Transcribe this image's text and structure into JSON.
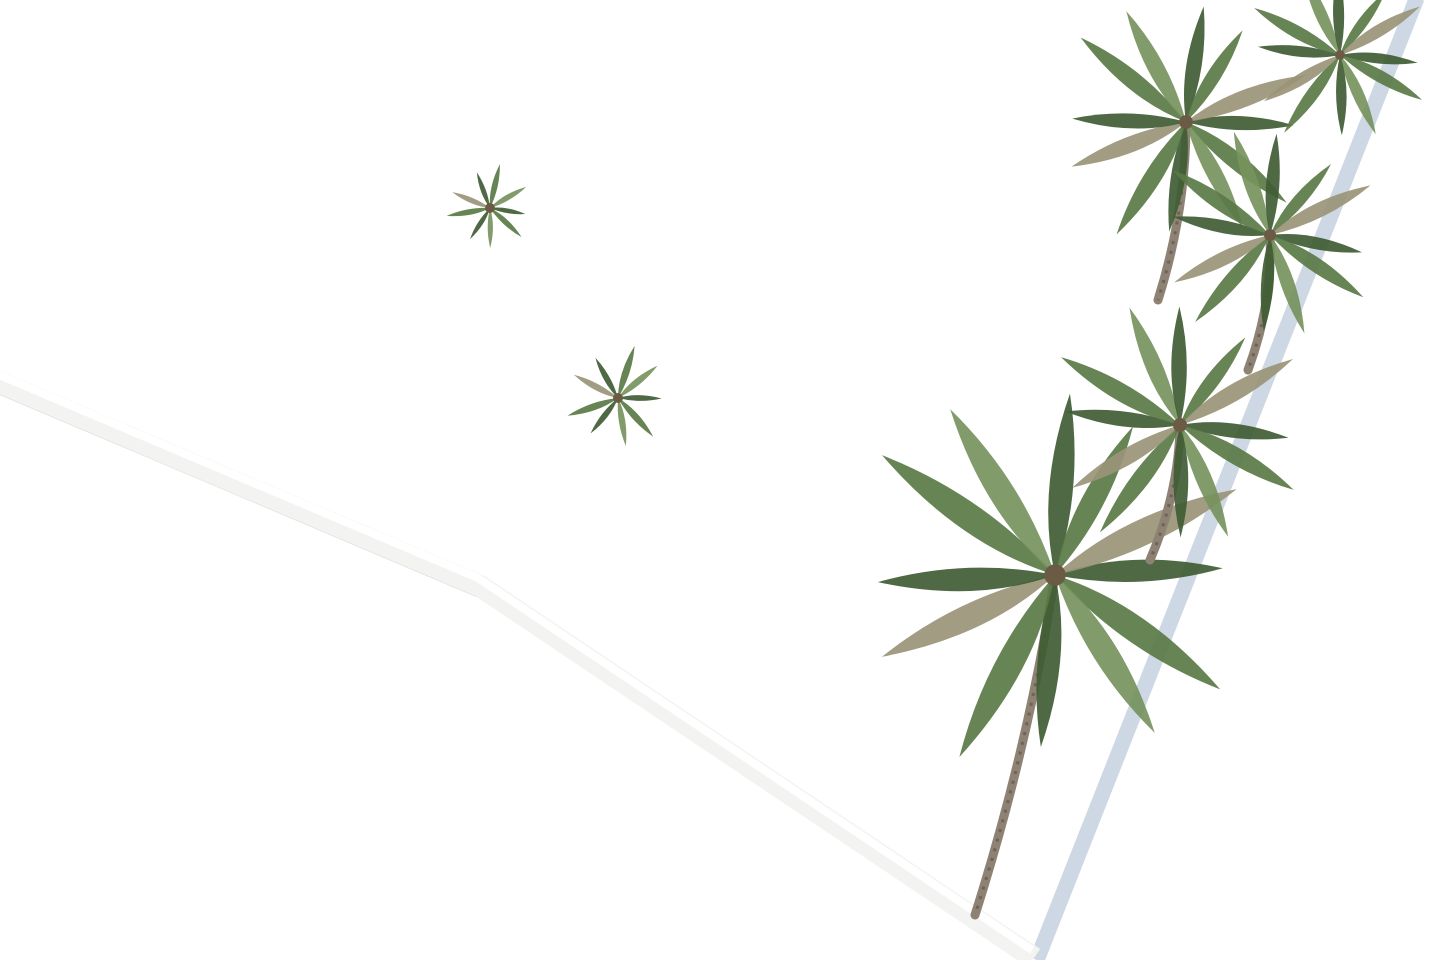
{
  "scene": {
    "type": "aerial-3d-architectural-render",
    "palette": {
      "bg": "#ffffff",
      "paving": "#dfdfda",
      "tile_line": "#c9c9c2",
      "villa_white": "#fcfdfd",
      "villa_face": "#f2f3f4",
      "villa_shade": "#e4e7e9",
      "roof_floor": "#e7dcc9",
      "roof_floor_line": "#d9cdb8",
      "window_dark": "#22262b",
      "wood": "#b38b5b",
      "pool_rim": "#f6f6f3",
      "water_light": "#7de4e9",
      "water_mid": "#3cc4d4",
      "water_deep": "#1da0b8",
      "water_teal_light": "#5fd6c6",
      "water_teal_deep": "#23a496",
      "lawn": "#2f5526",
      "lawn_dark": "#24421c",
      "bush_dark": "#27461e",
      "bush_mid": "#35602a",
      "bush_light": "#4d8040",
      "palm_dark": "#3f5c33",
      "palm_mid": "#5a7a46",
      "palm_light": "#76925d",
      "palm_dry": "#9a9478",
      "trunk": "#8e8274",
      "street_dark": "#141619",
      "gate_darker": "#0d0f10",
      "gravel": "#d8d4cc",
      "wall_white": "#f3f4f2",
      "wall_blue": "#cdd8e4",
      "wall_shadow": "#aebecd",
      "wall_under": "#d8dad7",
      "car_silver": "#cac6bd",
      "car_silver_edge": "#aaa69c",
      "car_glass": "#1a1c1e",
      "car_dark": "#262e3e",
      "car_dark_glass": "#0e1116",
      "shadow": "#343a40"
    },
    "site": {
      "polygon": [
        [
          0,
          0
        ],
        [
          1410,
          0
        ],
        [
          1032,
          956
        ],
        [
          482,
          585
        ],
        [
          0,
          378
        ]
      ],
      "right_wall": [
        [
          1412,
          -4
        ],
        [
          1032,
          958
        ]
      ],
      "bottom_wall": [
        [
          -6,
          380
        ],
        [
          480,
          586
        ],
        [
          1034,
          958
        ]
      ]
    },
    "villas": [
      {
        "cx": 118,
        "cy": 112,
        "w": 310,
        "h": 218,
        "a": -20,
        "tower": false
      },
      {
        "cx": 500,
        "cy": 258,
        "w": 345,
        "h": 300,
        "a": -23,
        "tower": true
      },
      {
        "cx": 868,
        "cy": 146,
        "w": 300,
        "h": 255,
        "a": -25,
        "tower": false
      },
      {
        "cx": 1128,
        "cy": 40,
        "w": 270,
        "h": 210,
        "a": -27,
        "tower": false
      },
      {
        "cx": 1338,
        "cy": -50,
        "w": 210,
        "h": 180,
        "a": -28,
        "tower": false
      },
      {
        "cx": 30,
        "cy": -58,
        "w": 240,
        "h": 170,
        "a": -18,
        "tower": false
      },
      {
        "cx": 268,
        "cy": -56,
        "w": 250,
        "h": 170,
        "a": -21,
        "tower": false
      },
      {
        "cx": 628,
        "cy": -80,
        "w": 280,
        "h": 185,
        "a": -23,
        "tower": false
      },
      {
        "cx": 960,
        "cy": -70,
        "w": 260,
        "h": 175,
        "a": -25,
        "tower": false
      }
    ],
    "stair_roofs": [
      {
        "cx": 452,
        "cy": 82,
        "w": 118,
        "h": 62,
        "a": -21
      },
      {
        "cx": 574,
        "cy": 50,
        "w": 116,
        "h": 58,
        "a": -22
      },
      {
        "cx": 800,
        "cy": 92,
        "w": 118,
        "h": 60,
        "a": -24
      },
      {
        "cx": 1085,
        "cy": -8,
        "w": 100,
        "h": 50,
        "a": -26
      }
    ],
    "pools": [
      {
        "cx": 260,
        "cy": 227,
        "len": 148,
        "wid": 58,
        "a": -21,
        "teal": true
      },
      {
        "cx": 845,
        "cy": 546,
        "len": 436,
        "wid": 110,
        "a": -17,
        "teal": false
      },
      {
        "cx": 1012,
        "cy": 440,
        "len": 330,
        "wid": 94,
        "a": -31,
        "teal": false
      },
      {
        "cx": 1220,
        "cy": 204,
        "len": 228,
        "wid": 70,
        "a": -31,
        "teal": false
      }
    ],
    "lawns": [
      [
        [
          562,
          696
        ],
        [
          1008,
          514
        ],
        [
          1165,
          612
        ],
        [
          1034,
          952
        ],
        [
          662,
          706
        ]
      ],
      [
        [
          866,
          562
        ],
        [
          1158,
          320
        ],
        [
          1240,
          405
        ],
        [
          970,
          640
        ]
      ],
      [
        [
          1116,
          218
        ],
        [
          1300,
          62
        ],
        [
          1350,
          128
        ],
        [
          1194,
          292
        ]
      ],
      [
        [
          0,
          164
        ],
        [
          28,
          170
        ],
        [
          32,
          208
        ],
        [
          0,
          202
        ]
      ],
      [
        [
          228,
          136
        ],
        [
          262,
          126
        ],
        [
          270,
          198
        ],
        [
          238,
          206
        ]
      ]
    ],
    "garden_walls": [
      [
        562,
        698,
        1010,
        516
      ],
      [
        866,
        564,
        1160,
        322
      ],
      [
        1050,
        358,
        1334,
        446
      ],
      [
        1116,
        220,
        1302,
        66
      ]
    ],
    "dark_panels": [
      [
        [
          130,
          2
        ],
        [
          338,
          2
        ],
        [
          338,
          40
        ],
        [
          130,
          86
        ]
      ],
      [
        [
          104,
          252
        ],
        [
          292,
          322
        ],
        [
          292,
          434
        ],
        [
          104,
          362
        ]
      ],
      [
        [
          196,
          320
        ],
        [
          290,
          354
        ],
        [
          290,
          432
        ],
        [
          196,
          400
        ]
      ],
      [
        [
          100,
          238
        ],
        [
          192,
          314
        ],
        [
          180,
          332
        ],
        [
          88,
          258
        ]
      ],
      [
        [
          44,
          148
        ],
        [
          64,
          152
        ],
        [
          64,
          200
        ],
        [
          44,
          196
        ]
      ]
    ],
    "ground_shadows": [
      [
        1100,
        640,
        170,
        52,
        -18
      ],
      [
        1225,
        492,
        110,
        36,
        -25
      ],
      [
        1245,
        175,
        100,
        34,
        -30
      ],
      [
        700,
        520,
        60,
        18,
        -20
      ]
    ],
    "bushes": [
      [
        470,
        577,
        24
      ],
      [
        520,
        601,
        20
      ],
      [
        588,
        625,
        26
      ],
      [
        652,
        658,
        28
      ],
      [
        706,
        690,
        30
      ],
      [
        762,
        722,
        26
      ],
      [
        822,
        790,
        30
      ],
      [
        882,
        802,
        28
      ],
      [
        934,
        842,
        26
      ],
      [
        212,
        390,
        26
      ],
      [
        250,
        416,
        20
      ],
      [
        318,
        448,
        24
      ],
      [
        348,
        470,
        19
      ],
      [
        700,
        330,
        32
      ],
      [
        738,
        382,
        25
      ],
      [
        764,
        420,
        21
      ],
      [
        955,
        282,
        26
      ],
      [
        1002,
        312,
        22
      ],
      [
        950,
        902,
        44
      ],
      [
        1006,
        930,
        38
      ],
      [
        903,
        884,
        30
      ],
      [
        1176,
        560,
        33
      ],
      [
        1224,
        594,
        25
      ],
      [
        1250,
        256,
        27
      ],
      [
        1298,
        290,
        21
      ],
      [
        1340,
        120,
        27
      ],
      [
        1382,
        88,
        21
      ],
      [
        608,
        352,
        19
      ],
      [
        660,
        372,
        15
      ],
      [
        28,
        300,
        21
      ],
      [
        58,
        330,
        17
      ],
      [
        595,
        598,
        22
      ],
      [
        430,
        556,
        20
      ]
    ],
    "palms": [
      {
        "x": 1055,
        "y": 575,
        "r": 215,
        "trunk": [
          1055,
          575,
          975,
          915
        ]
      },
      {
        "x": 1180,
        "y": 425,
        "r": 140,
        "trunk": [
          1180,
          425,
          1150,
          560
        ]
      },
      {
        "x": 1186,
        "y": 122,
        "r": 138,
        "trunk": [
          1186,
          122,
          1158,
          300
        ]
      },
      {
        "x": 1270,
        "y": 235,
        "r": 120,
        "trunk": [
          1270,
          235,
          1248,
          370
        ]
      },
      {
        "x": 1340,
        "y": 55,
        "r": 100,
        "trunk": null
      },
      {
        "x": 618,
        "y": 398,
        "r": 56,
        "trunk": null
      },
      {
        "x": 490,
        "y": 208,
        "r": 46,
        "trunk": null
      }
    ],
    "furniture": [
      [
        562,
        472,
        72,
        24,
        -21
      ],
      [
        540,
        502,
        30,
        20,
        -21
      ],
      [
        706,
        448,
        66,
        24,
        -21
      ],
      [
        624,
        574,
        54,
        15,
        -19
      ],
      [
        646,
        598,
        54,
        15,
        -19
      ],
      [
        600,
        552,
        50,
        14,
        -19
      ],
      [
        132,
        228,
        62,
        22,
        -19
      ],
      [
        208,
        202,
        42,
        16,
        -19
      ],
      [
        858,
        392,
        72,
        30,
        -26
      ],
      [
        938,
        348,
        46,
        13,
        -26
      ],
      [
        966,
        329,
        46,
        13,
        -26
      ],
      [
        994,
        310,
        46,
        13,
        -26
      ],
      [
        1022,
        291,
        46,
        13,
        -26
      ],
      [
        1148,
        218,
        62,
        24,
        -28
      ],
      [
        1240,
        152,
        44,
        12,
        -28
      ],
      [
        1264,
        136,
        44,
        12,
        -28
      ],
      [
        92,
        22,
        48,
        14,
        -18
      ],
      [
        148,
        34,
        30,
        11,
        -18
      ]
    ],
    "chairs": [
      [
        586,
        508,
        11
      ],
      [
        602,
        480,
        5
      ],
      [
        568,
        486,
        5
      ],
      [
        612,
        522,
        5
      ],
      [
        574,
        530,
        5
      ],
      [
        736,
        470,
        5
      ],
      [
        720,
        440,
        5
      ],
      [
        696,
        476,
        5
      ],
      [
        168,
        214,
        5
      ],
      [
        150,
        240,
        5
      ],
      [
        896,
        380,
        5
      ],
      [
        880,
        408,
        5
      ],
      [
        1136,
        242,
        5
      ],
      [
        1170,
        206,
        5
      ],
      [
        1044,
        302,
        6
      ],
      [
        1020,
        320,
        6
      ],
      [
        120,
        14,
        9
      ]
    ],
    "plant_pots": [
      [
        612,
        446,
        8
      ],
      [
        530,
        452,
        7
      ],
      [
        684,
        306,
        7
      ],
      [
        40,
        12,
        6
      ],
      [
        1005,
        268,
        6
      ]
    ],
    "cars": [
      {
        "cx": 336,
        "cy": 404,
        "len": 118,
        "wid": 50,
        "a": -27,
        "kind": "silver"
      },
      {
        "cx": 70,
        "cy": 247,
        "len": 102,
        "wid": 44,
        "a": -18,
        "kind": "dark"
      }
    ]
  }
}
